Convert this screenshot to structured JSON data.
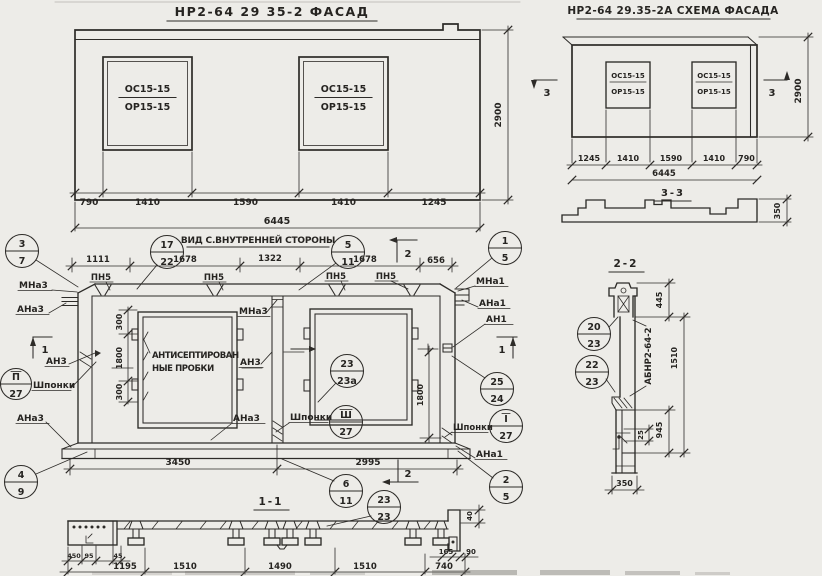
{
  "facade": {
    "title": "НР2-64 29 35-2 ФАСАД",
    "height": "2900",
    "total": "6445",
    "dims": [
      "790",
      "1410",
      "1590",
      "1410",
      "1245"
    ],
    "win_top": "ОС15-15",
    "win_bot": "ОР15-15"
  },
  "schema": {
    "title": "НР2-64 29.35-2А СХЕМА ФАСАДА",
    "height": "2900",
    "total": "6445",
    "dims": [
      "1245",
      "1410",
      "1590",
      "1410",
      "790"
    ],
    "win_top": "ОС15-15",
    "win_bot": "ОР15-15",
    "mark": "3",
    "sec_title": "3-3",
    "sec_dim": "350"
  },
  "inner": {
    "title": "ВИД С.ВНУТРЕННЕЙ СТОРОНЫ",
    "top_dims": [
      "1111",
      "1678",
      "1322",
      "1678",
      "656"
    ],
    "bot_dims": [
      "3450",
      "2995"
    ],
    "left_dims": [
      "300",
      "1800",
      "300"
    ],
    "right_dim": "1800",
    "pn5": "ПН5",
    "mna3": "МНа3",
    "ana3": "АНа3",
    "an3": "АН3",
    "mna1": "МНа1",
    "ana1": "АНа1",
    "an1": "АН1",
    "shponki": "Шпонки",
    "note1": "АНТИСЕПТИРОВАН",
    "note2": "НЫЕ ПРОБКИ",
    "mark1": "1",
    "mark2": "2"
  },
  "callouts": {
    "c37": {
      "t": "3",
      "b": "7"
    },
    "c1722": {
      "t": "17",
      "b": "22"
    },
    "c511": {
      "t": "5",
      "b": "11"
    },
    "c15": {
      "t": "1",
      "b": "5"
    },
    "c227": {
      "t": "П",
      "b": "27"
    },
    "c2323a": {
      "t": "23",
      "b": "23а"
    },
    "c2524": {
      "t": "25",
      "b": "24"
    },
    "c327": {
      "t": "Ш",
      "b": "27"
    },
    "c127": {
      "t": "I",
      "b": "27"
    },
    "c49": {
      "t": "4",
      "b": "9"
    },
    "c611": {
      "t": "6",
      "b": "11"
    },
    "c2323": {
      "t": "23",
      "b": "23"
    },
    "c25": {
      "t": "2",
      "b": "5"
    },
    "c2023": {
      "t": "20",
      "b": "23"
    },
    "c2223": {
      "t": "22",
      "b": "23"
    }
  },
  "sec22": {
    "title": "2-2",
    "d445": "445",
    "d1510": "1510",
    "d25": "25",
    "d945": "945",
    "d350": "350",
    "label": "АБНР2-64-2"
  },
  "sec11": {
    "title": "1-1",
    "small_dims": [
      "450",
      "95",
      "45"
    ],
    "d165": "165",
    "d90": "90",
    "d40": "40",
    "main_dims": [
      "1195",
      "1510",
      "1490",
      "1510",
      "740"
    ]
  }
}
